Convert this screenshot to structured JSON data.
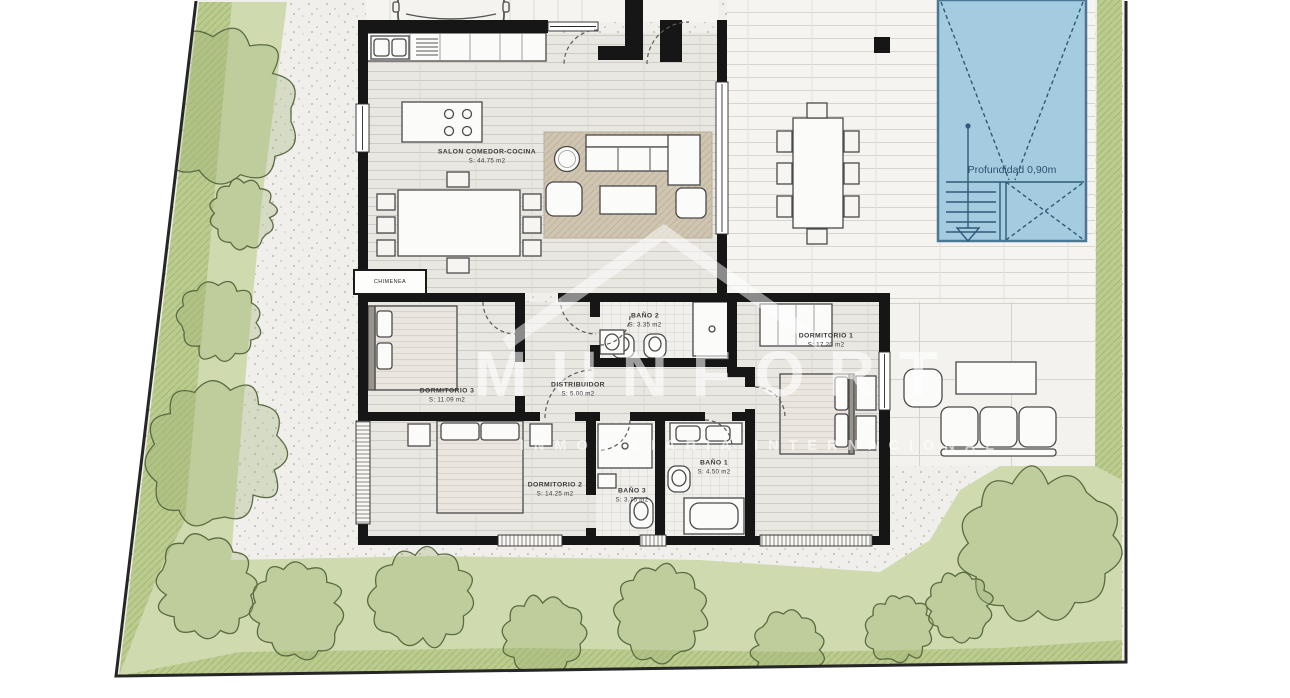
{
  "plan": {
    "watermark": {
      "brand": "MUNFORT",
      "tagline": "INMOBILIARIA INTERNACIONAL"
    },
    "pool": {
      "depth_label": "Profundidad 0,90m"
    },
    "fireplace_label": "CHIMENEA",
    "rooms": {
      "salon": {
        "name": "SALON COMEDOR-COCINA",
        "area": "S: 44.75 m2"
      },
      "dormitorio1": {
        "name": "DORMITORIO 1",
        "area": "S: 17.20 m2"
      },
      "dormitorio2": {
        "name": "DORMITORIO 2",
        "area": "S: 14.25 m2"
      },
      "dormitorio3": {
        "name": "DORMITORIO 3",
        "area": "S: 11.09 m2"
      },
      "bano1": {
        "name": "BAÑO 1",
        "area": "S: 4.50 m2"
      },
      "bano2": {
        "name": "BAÑO 2",
        "area": "S: 3.35 m2"
      },
      "bano3": {
        "name": "BAÑO 3",
        "area": "S: 3.75 m2"
      },
      "distribuidor": {
        "name": "DISTRIBUIDOR",
        "area": "S: 5.00 m2"
      }
    },
    "colors": {
      "pool_water": "#a5cbe0",
      "pool_line": "#2f5a78",
      "garden_light": "#cfdbae",
      "garden_dark": "#bccb90",
      "gravel": "#f0efeb",
      "wall": "#161616",
      "rug": "#cfc5b1",
      "watermark": "#ffffff"
    }
  }
}
